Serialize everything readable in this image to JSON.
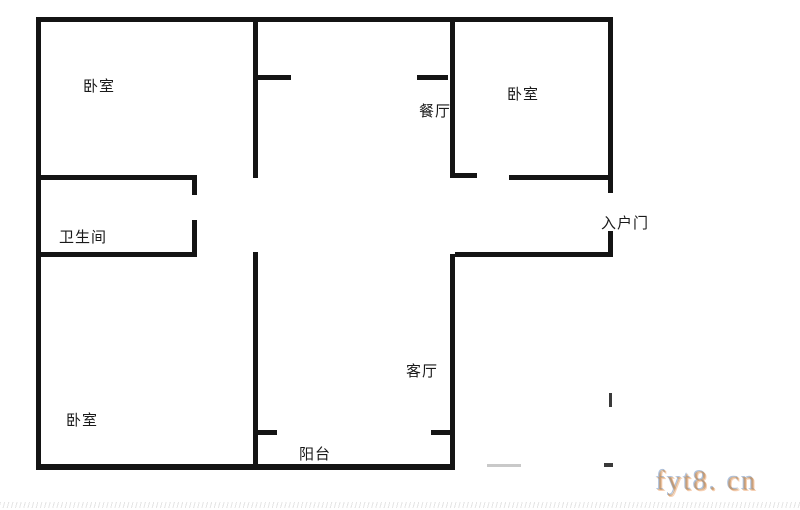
{
  "floorplan": {
    "type": "apartment-floor-plan",
    "rooms": {
      "bedroom_top_left": {
        "label": "卧室"
      },
      "dining": {
        "label": "餐厅"
      },
      "bedroom_top_right": {
        "label": "卧室"
      },
      "bathroom": {
        "label": "卫生间"
      },
      "entry_door": {
        "label": "入户门"
      },
      "living": {
        "label": "客厅"
      },
      "bedroom_bottom_left": {
        "label": "卧室"
      },
      "balcony": {
        "label": "阳台"
      }
    },
    "watermark": {
      "text": "fyt8. cn"
    },
    "colors": {
      "wall": "#141414",
      "label": "#1a1a1a",
      "watermark_main": "#c18a52",
      "watermark_fringe": "#6f8fc0",
      "background": "#ffffff"
    }
  }
}
